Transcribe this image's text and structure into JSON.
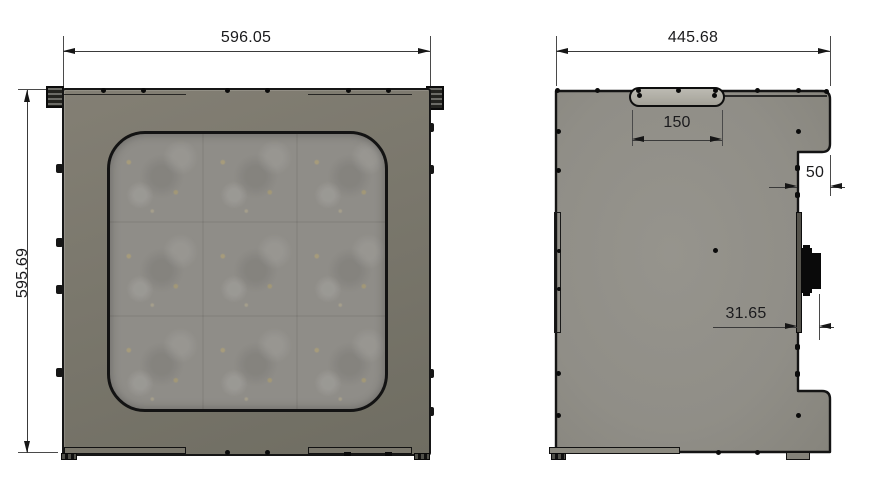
{
  "front_view": {
    "width_label": "596.05",
    "height_label": "595.69"
  },
  "side_view": {
    "width_label": "445.68",
    "handle_label": "150",
    "step_label": "50",
    "connector_label": "31.65"
  },
  "colors": {
    "background": "#ffffff",
    "outline": "#141414",
    "front_frame": "#7a776c",
    "window": "#8f8d88",
    "side_panel": "#908e87",
    "handle": "#b0aea6",
    "connector": "#0a0a0a"
  }
}
